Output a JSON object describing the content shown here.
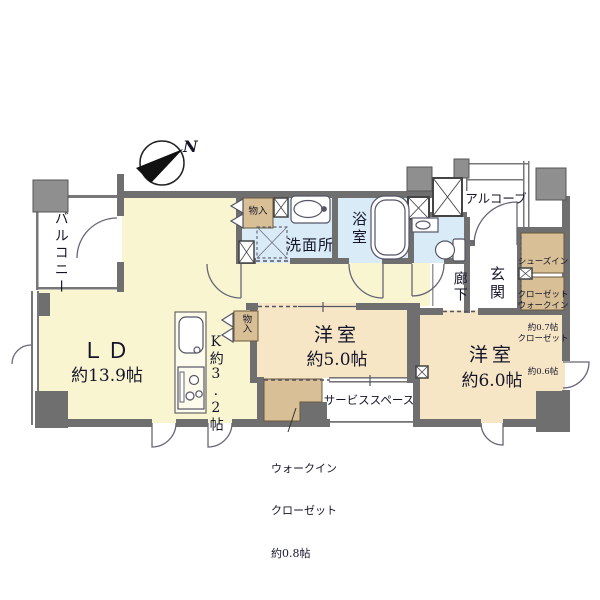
{
  "compass": {
    "north_label": "N"
  },
  "rooms": {
    "balcony": {
      "label": "バルコニー"
    },
    "living_dining": {
      "label": "ＬＤ",
      "size": "約13.9帖"
    },
    "kitchen": {
      "label": "K約3.2帖"
    },
    "washroom": {
      "label": "洗面所"
    },
    "bathroom": {
      "label": "浴室"
    },
    "hallway": {
      "label": "廊下"
    },
    "entrance": {
      "label": "玄関"
    },
    "alcove": {
      "label": "アルコーブ"
    },
    "bedroom_5": {
      "label": "洋室",
      "size": "約5.0帖"
    },
    "bedroom_6": {
      "label": "洋室",
      "size": "約6.0帖"
    },
    "service_space": {
      "label": "サービススペース"
    },
    "storage_top": {
      "label": "物入"
    },
    "storage_mid": {
      "label": "物入"
    },
    "shoes_in_closet": {
      "line1": "シューズイン",
      "line2": "クローゼット",
      "line3": "約0.7帖"
    },
    "walk_in_closet_06": {
      "line1": "ウォークイン",
      "line2": "クローゼット",
      "line3": "約0.6帖"
    },
    "walk_in_closet_08": {
      "line1": "ウォークイン",
      "line2": "クローゼット",
      "line3": "約0.8帖"
    }
  },
  "colors": {
    "living_area": "#f8f5d0",
    "bedroom": "#f7e6c6",
    "wet_area": "#d9ebf6",
    "closet": "#d8bf95",
    "wall": "#6f6f6f",
    "pillar": "#8f8f8f",
    "text": "#15152a"
  }
}
